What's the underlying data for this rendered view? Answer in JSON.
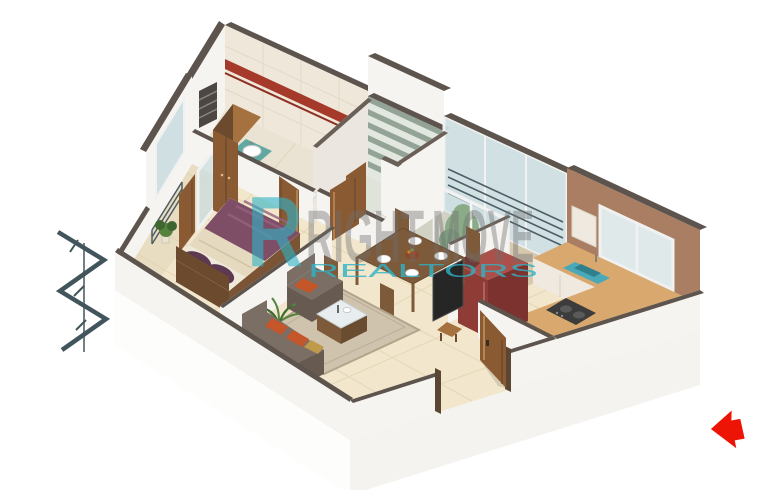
{
  "title": "3D isometric one-bedroom apartment floor plan render",
  "watermark": {
    "logo_letter": "R",
    "word1": "RIGHT",
    "word2": "MOVE",
    "subtitle": "REALTORS"
  },
  "entry_arrow": {
    "direction": "left",
    "meaning": "main entrance"
  },
  "palette": {
    "bg": "#ffffff",
    "wallTop": "#5d544d",
    "wallTop2": "#6a6058",
    "wallFace": "#f6f4f0",
    "wallShade": "#ebe7e0",
    "floor": "#f2e7cc",
    "grout": "#dfd2b0",
    "bathFloor": "#eae3d3",
    "wcFloor": "#dfe3da",
    "balcFloor": "#d6c9ae",
    "sideBalcFloor": "#e8dcc1",
    "glass": "#ccdde1",
    "frame": "#f0f1f0",
    "wood": "#8a5a33",
    "woodLight": "#a5713f",
    "woodDark": "#6b4a2e",
    "tile": "#efe8da",
    "tileRed": "#a63a2a",
    "stripeGreen": "#93a497",
    "stripeLight": "#e2e7df",
    "kitchenWall": "#a97e62",
    "granite": "#d8a86e",
    "cabinet": "#efe9e0",
    "sink": "#4aa9b8",
    "teal": "#5fa9a2",
    "fridge": "#8f3b36",
    "fridgeLight": "#a9514a",
    "fridgeDark": "#7c322e",
    "stove": "#3c3c3c",
    "sofa": "#7b6e64",
    "sofaDark": "#665a51",
    "cushion": "#c4562a",
    "mustard": "#c09a4b",
    "rug": "#cfc3ae",
    "rugEdge": "#b3a58c",
    "duvet": "#7e4e66",
    "duvetHi": "#96627f",
    "pillow": "#5d3a52",
    "blanket": "#e5d9bf",
    "tableWood": "#7d5a3a",
    "chairPad": "#6e3a36",
    "tv": "#262626",
    "plant": "#55823c",
    "plantDark": "#3f6530",
    "slab": "#fdfdfc",
    "slabSide": "#f5f3ef",
    "arrow": "#ee1405",
    "steel": "#42555c",
    "railing": "#4e5e66",
    "chrome": "#9aa0a4",
    "wmTeal": "#2fb3c7",
    "wmGray": "#6f6f6f"
  },
  "rooms": [
    {
      "name": "bathroom"
    },
    {
      "name": "toilet"
    },
    {
      "name": "rear-balcony"
    },
    {
      "name": "kitchen"
    },
    {
      "name": "bedroom"
    },
    {
      "name": "side-balcony"
    },
    {
      "name": "living-dining-hall"
    },
    {
      "name": "entrance-foyer"
    }
  ],
  "objects": [
    "double-bed",
    "wardrobe",
    "dining-table",
    "dining-chairs",
    "sofa",
    "armchair",
    "coffee-table",
    "rug",
    "television",
    "refrigerator",
    "kitchen-counter",
    "kitchen-sink",
    "gas-stove",
    "washbasin",
    "toilet-seat",
    "shower",
    "potted-plants",
    "wooden-doors",
    "balcony-railing",
    "entrance-door"
  ]
}
